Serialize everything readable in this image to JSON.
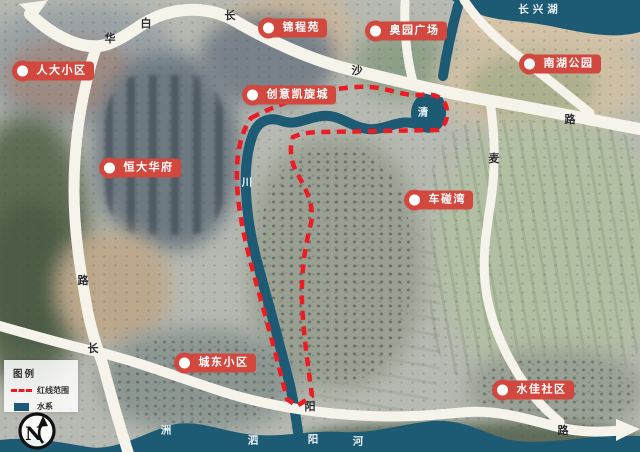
{
  "title": "城市地块区位卫星图",
  "lake_name": "长兴湖",
  "markers": [
    {
      "label": "人大小区",
      "x": 22,
      "y": 71
    },
    {
      "label": "锦程苑",
      "x": 268,
      "y": 28
    },
    {
      "label": "奥园广场",
      "x": 375,
      "y": 31
    },
    {
      "label": "南湖公园",
      "x": 529,
      "y": 64
    },
    {
      "label": "创意凯旋城",
      "x": 252,
      "y": 95
    },
    {
      "label": "恒大华府",
      "x": 109,
      "y": 168
    },
    {
      "label": "车碰湾",
      "x": 414,
      "y": 200
    },
    {
      "label": "城东小区",
      "x": 184,
      "y": 363
    },
    {
      "label": "水佳社区",
      "x": 502,
      "y": 390
    }
  ],
  "road_labels": [
    {
      "text": "白",
      "x": 146,
      "y": 23
    },
    {
      "text": "华",
      "x": 110,
      "y": 38
    },
    {
      "text": "长",
      "x": 230,
      "y": 15
    },
    {
      "text": "沙",
      "x": 357,
      "y": 70
    },
    {
      "text": "路",
      "x": 570,
      "y": 119
    },
    {
      "text": "麦",
      "x": 494,
      "y": 158
    },
    {
      "text": "路",
      "x": 83,
      "y": 280
    },
    {
      "text": "长",
      "x": 93,
      "y": 348
    },
    {
      "text": "阳",
      "x": 310,
      "y": 406
    },
    {
      "text": "路",
      "x": 563,
      "y": 430
    }
  ],
  "water_labels": [
    {
      "text": "长兴湖",
      "x": 540,
      "y": 9,
      "ls": 4
    },
    {
      "text": "清",
      "x": 423,
      "y": 112
    },
    {
      "text": "川",
      "x": 247,
      "y": 182
    },
    {
      "text": "洲",
      "x": 166,
      "y": 430
    },
    {
      "text": "泗",
      "x": 253,
      "y": 440
    },
    {
      "text": "阳",
      "x": 313,
      "y": 439
    },
    {
      "text": "河",
      "x": 358,
      "y": 441
    }
  ],
  "legend": {
    "title": "图例",
    "items": [
      {
        "type": "dashed-line",
        "label": "红线范围"
      },
      {
        "type": "fill",
        "label": "水系"
      }
    ]
  },
  "compass": {
    "letter": "N"
  },
  "colors": {
    "marker_red": "#d2483e",
    "boundary_red": "#ec1b24",
    "water": "#1d5a74",
    "road": "#f6f3ea"
  }
}
